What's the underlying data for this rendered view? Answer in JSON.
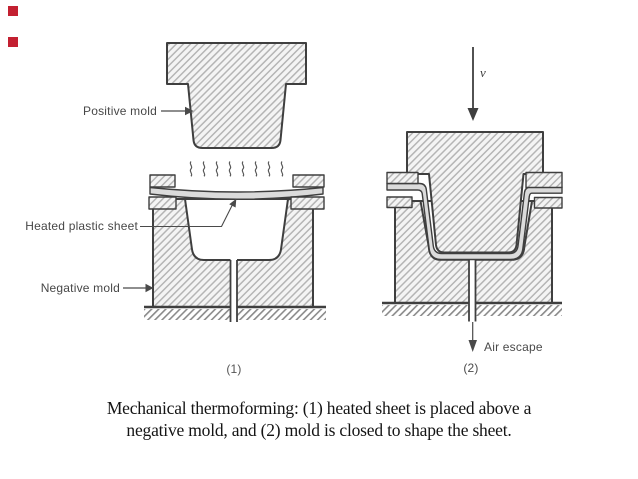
{
  "markers": {
    "color": "#c32031"
  },
  "diagram": {
    "left": {
      "label_positive_mold": "Positive mold",
      "label_heated_sheet": "Heated plastic sheet",
      "label_negative_mold": "Negative mold",
      "step_label": "(1)"
    },
    "right": {
      "velocity_label": "v",
      "air_escape_label": "Air escape",
      "step_label": "(2)"
    },
    "colors": {
      "outline": "#3f3f3f",
      "hatch_line": "#b5b5b5",
      "hatch_background": "#f4f4f4",
      "ground_hatch_line": "#8a8a8a",
      "sheet_fill": "#dbdbdb",
      "label_text": "#474747"
    }
  },
  "caption": {
    "line1": "Mechanical thermoforming: (1) heated sheet is placed above a",
    "line2": "negative mold, and (2) mold is closed to shape the sheet."
  }
}
